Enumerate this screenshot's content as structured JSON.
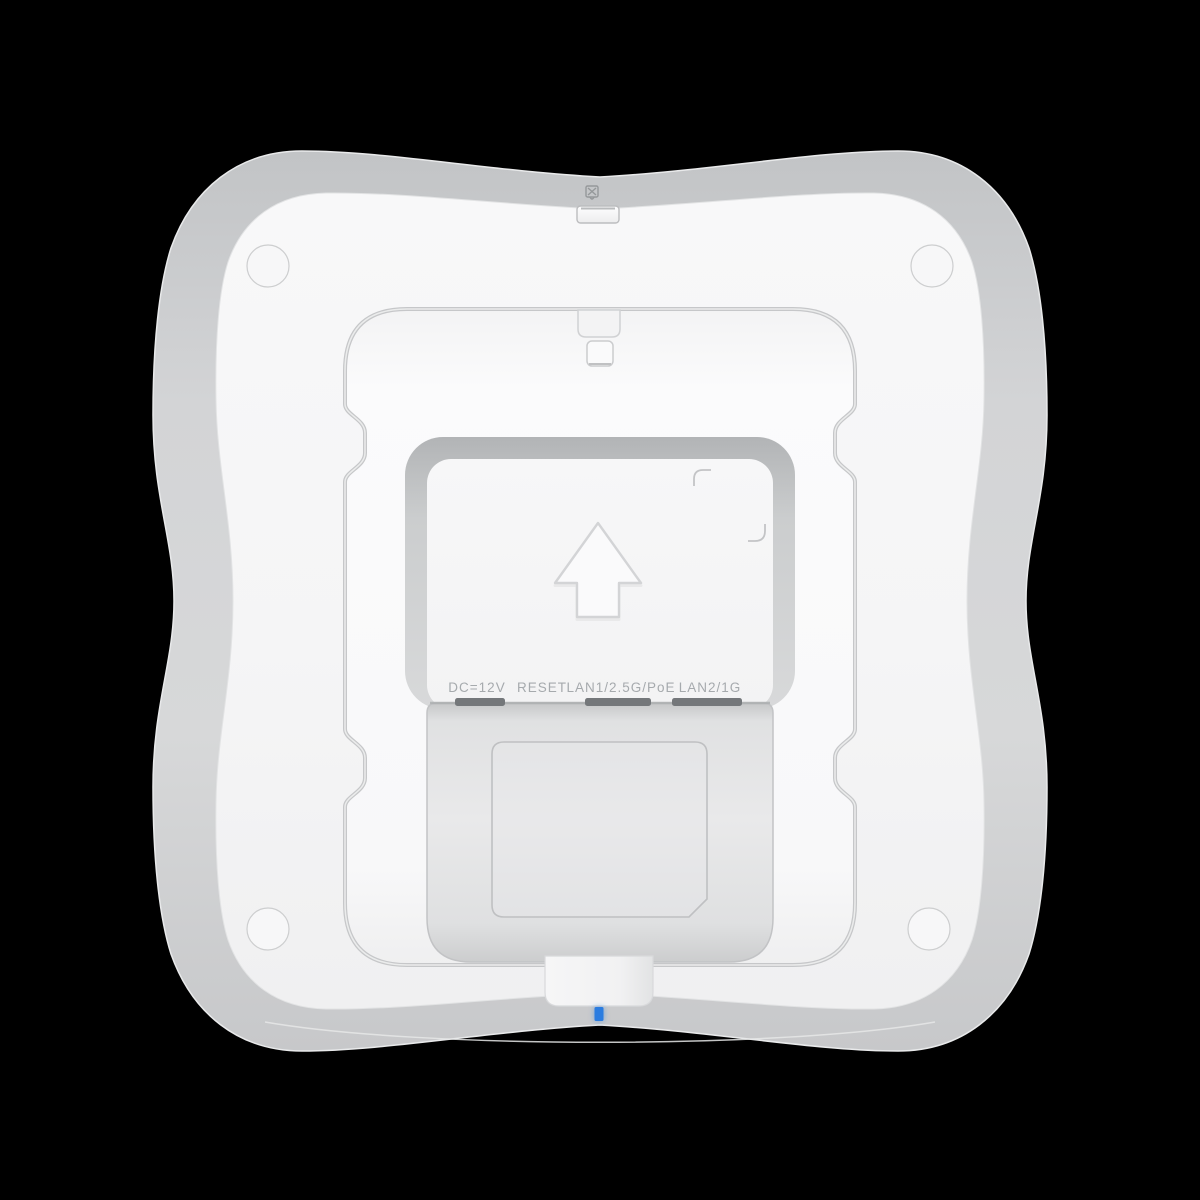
{
  "product": {
    "view": "access point rear panel",
    "port_labels": [
      {
        "text": "DC=12V"
      },
      {
        "text": "RESET"
      },
      {
        "text": "LAN1/2.5G/PoE"
      },
      {
        "text": "LAN2/1G"
      }
    ]
  },
  "status_led": {
    "color": "#2B7CE0"
  },
  "icons": {
    "arrow_up": "arrow-up-icon",
    "security_lock": "kensington-lock-icon"
  },
  "colors": {
    "body_rim": "#CDCED0",
    "face": "#F6F6F7",
    "recess": "#FAFAFB",
    "cavity": "#E7E7E8",
    "label_text": "#A6AAAD"
  }
}
